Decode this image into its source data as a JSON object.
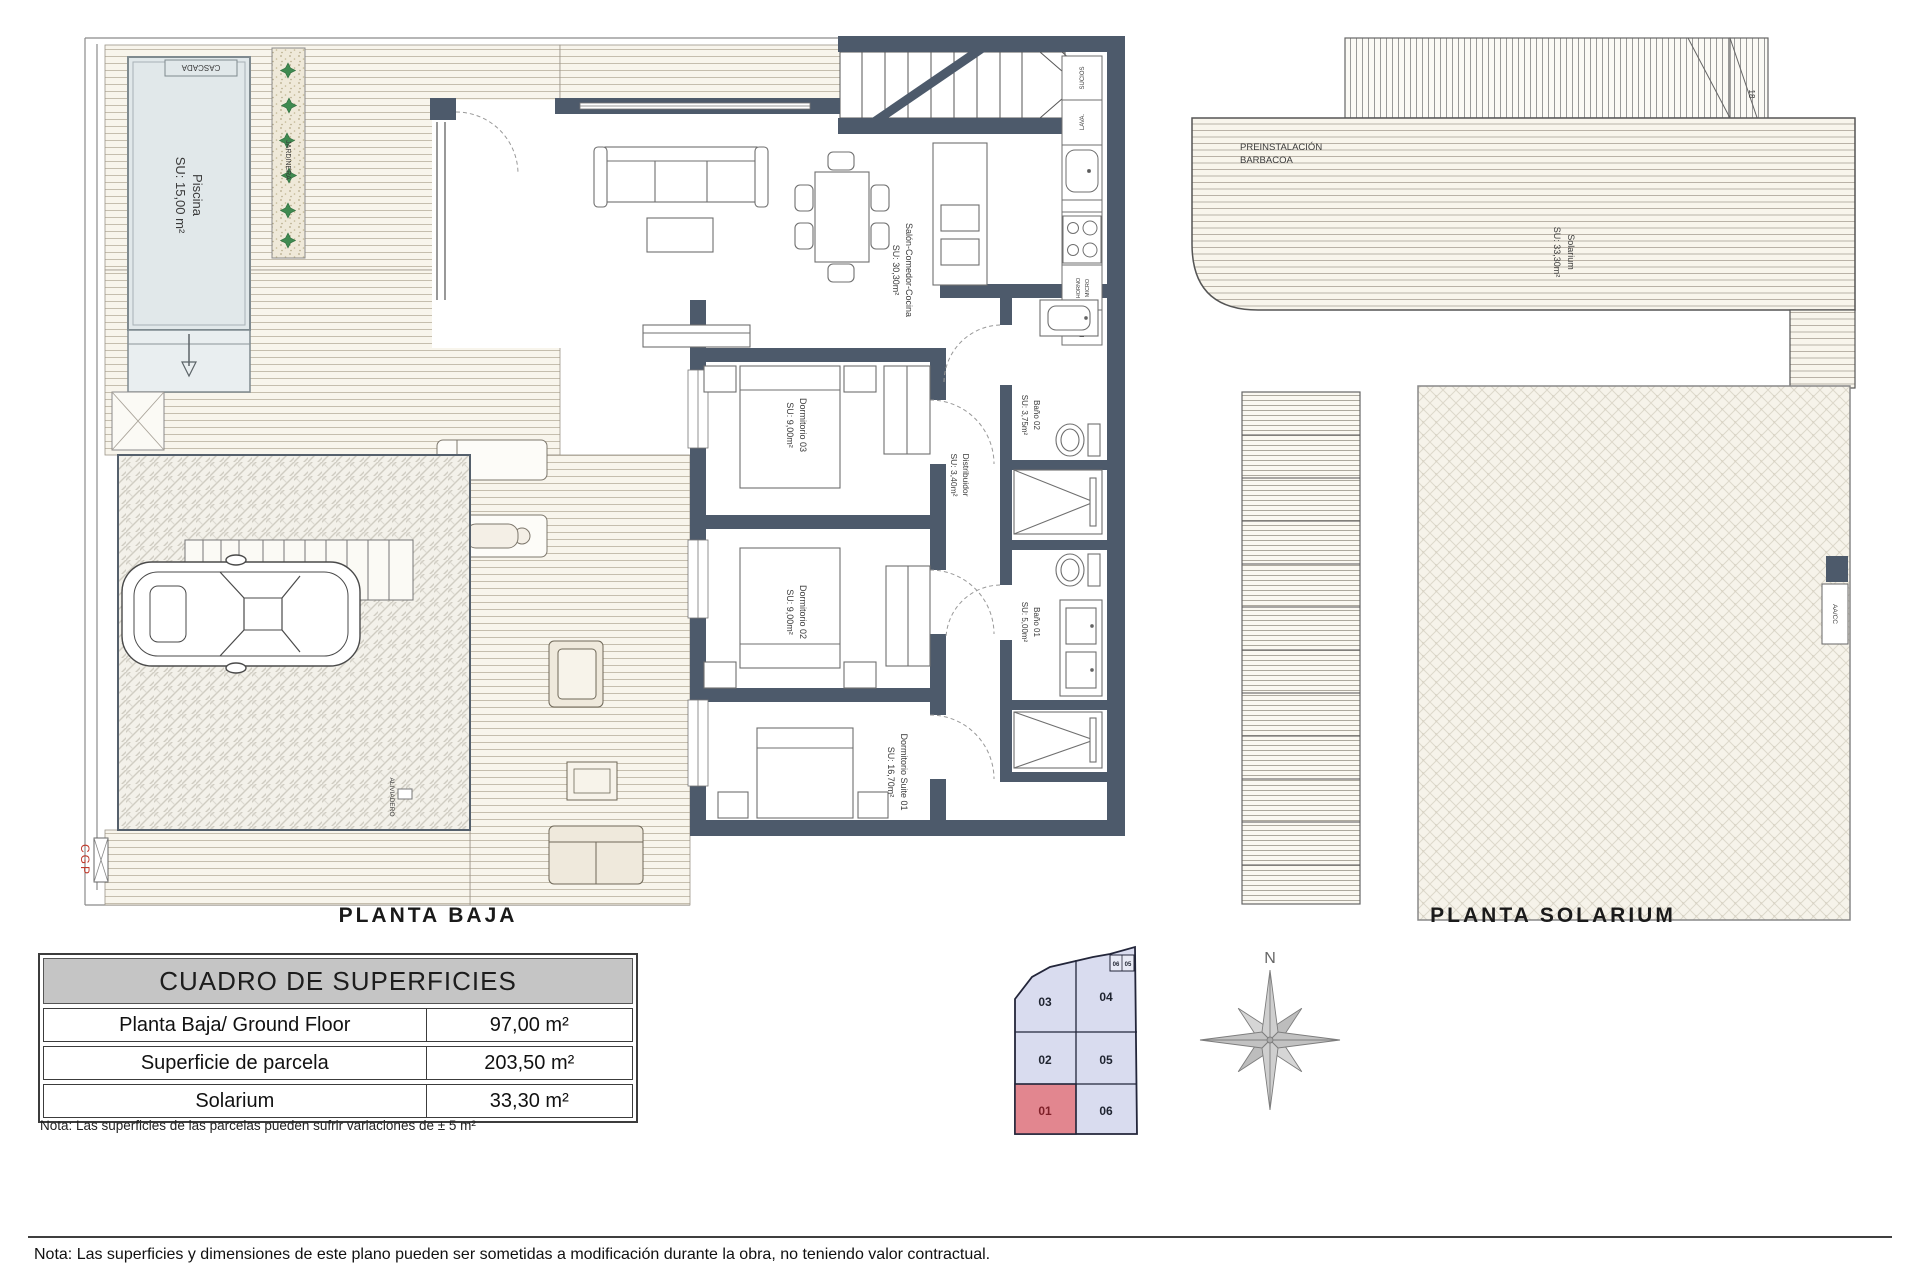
{
  "ground_floor": {
    "title": "PLANTA BAJA",
    "rooms": {
      "piscina": {
        "name": "Piscina",
        "area": "SU: 15,00 m²"
      },
      "terrazas": {
        "name": "TERRAZAS",
        "area": "SU: 52,00m²"
      },
      "salon": {
        "name": "Salón-Comedor-Cocina",
        "area": "SU: 30,30m²"
      },
      "dorm03": {
        "name": "Dormitorio 03",
        "area": "SU: 9,00m²"
      },
      "dorm02": {
        "name": "Dormitorio 02",
        "area": "SU: 9,00m²"
      },
      "suite": {
        "name": "Dormitorio Suite 01",
        "area": "SU: 16,70m²"
      },
      "distribuidor": {
        "name": "Distribuidor",
        "area": "SU: 3,40m²"
      },
      "bano02": {
        "name": "Baño 02",
        "area": "SU: 3,75m²"
      },
      "bano01": {
        "name": "Baño 01",
        "area": "SU: 5,00m²"
      }
    },
    "labels": {
      "cascada": "CASCADA",
      "jardinera": "JARDINERA",
      "motor_line1": "motor",
      "motor_line2": "piscina",
      "aliviadero": "ALIVIADERO",
      "cgp": "CGP"
    },
    "kitchen": {
      "sucios": "SUCIOS",
      "lava": "LAVA.",
      "horno_line1": "HORNO",
      "horno_line2": "MICRO",
      "frigo": "FRIGO"
    }
  },
  "solarium_floor": {
    "title": "PLANTA SOLARIUM",
    "barbacoa_line1": "PREINSTALACIÓN",
    "barbacoa_line2": "BARBACOA",
    "solarium": {
      "name": "Solarium",
      "area": "SU: 33,30m²"
    },
    "aacc": "AA/CC",
    "stair_number": "18"
  },
  "surfaces_table": {
    "title": "CUADRO DE SUPERFICIES",
    "rows": [
      {
        "label": "Planta Baja/ Ground Floor",
        "value": "97,00 m²"
      },
      {
        "label": "Superficie de parcela",
        "value": "203,50 m²"
      },
      {
        "label": "Solarium",
        "value": "33,30 m²"
      }
    ],
    "note": "Nota: Las superficies de las parcelas pueden sufrir variaciones de ± 5 m²"
  },
  "site_plan": {
    "cells": [
      {
        "id": "03"
      },
      {
        "id": "04"
      },
      {
        "id": "02"
      },
      {
        "id": "05"
      },
      {
        "id": "01"
      },
      {
        "id": "06"
      }
    ],
    "mini": [
      "06",
      "05"
    ],
    "highlighted": "01",
    "highlight_color": "#e2868f",
    "cell_color": "#d9dcef"
  },
  "compass": {
    "north": "N"
  },
  "footer_note": "Nota: Las superficies y dimensiones de este plano pueden ser sometidas a modificación durante la obra, no teniendo valor contractual.",
  "colors": {
    "wall": "#4d5a6b",
    "pool": "#e1e8ea",
    "accent_red": "#c0392b"
  }
}
